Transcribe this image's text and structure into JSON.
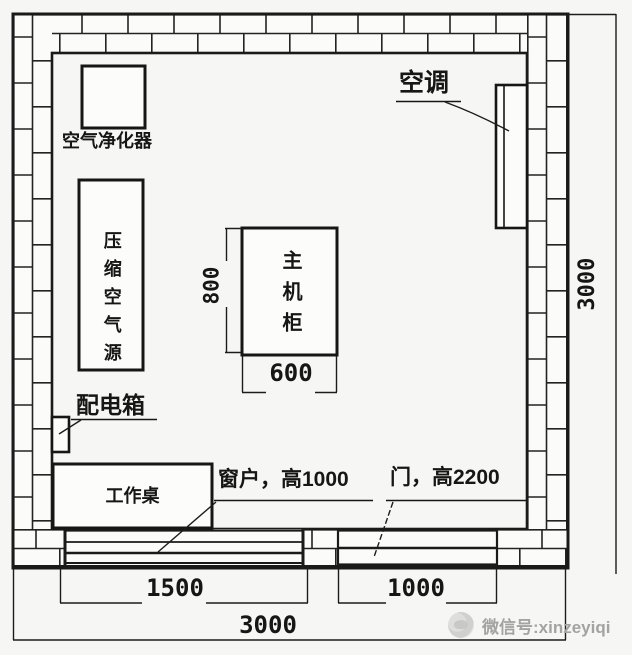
{
  "colors": {
    "line": "#1c1c1c",
    "background": "#f6f6f4",
    "paper_white": "#fcfcfb",
    "watermark_gray": "#a3a3a3"
  },
  "plan": {
    "equipment": {
      "air_purifier": "空气净化器",
      "compressed_air_source": "压缩空气源",
      "main_cabinet": "主机柜",
      "air_conditioner": "空调",
      "distribution_box": "配电箱",
      "work_desk": "工作桌"
    },
    "annotations": {
      "window": "窗户，高1000",
      "door": "门，高2200"
    },
    "dimensions": {
      "cabinet_depth": "800",
      "cabinet_width": "600",
      "window_width": "1500",
      "door_width": "1000",
      "room_width_bottom": "3000",
      "room_depth_right": "3000"
    },
    "watermark": {
      "label": "微信号:xinzeyiqi"
    }
  }
}
